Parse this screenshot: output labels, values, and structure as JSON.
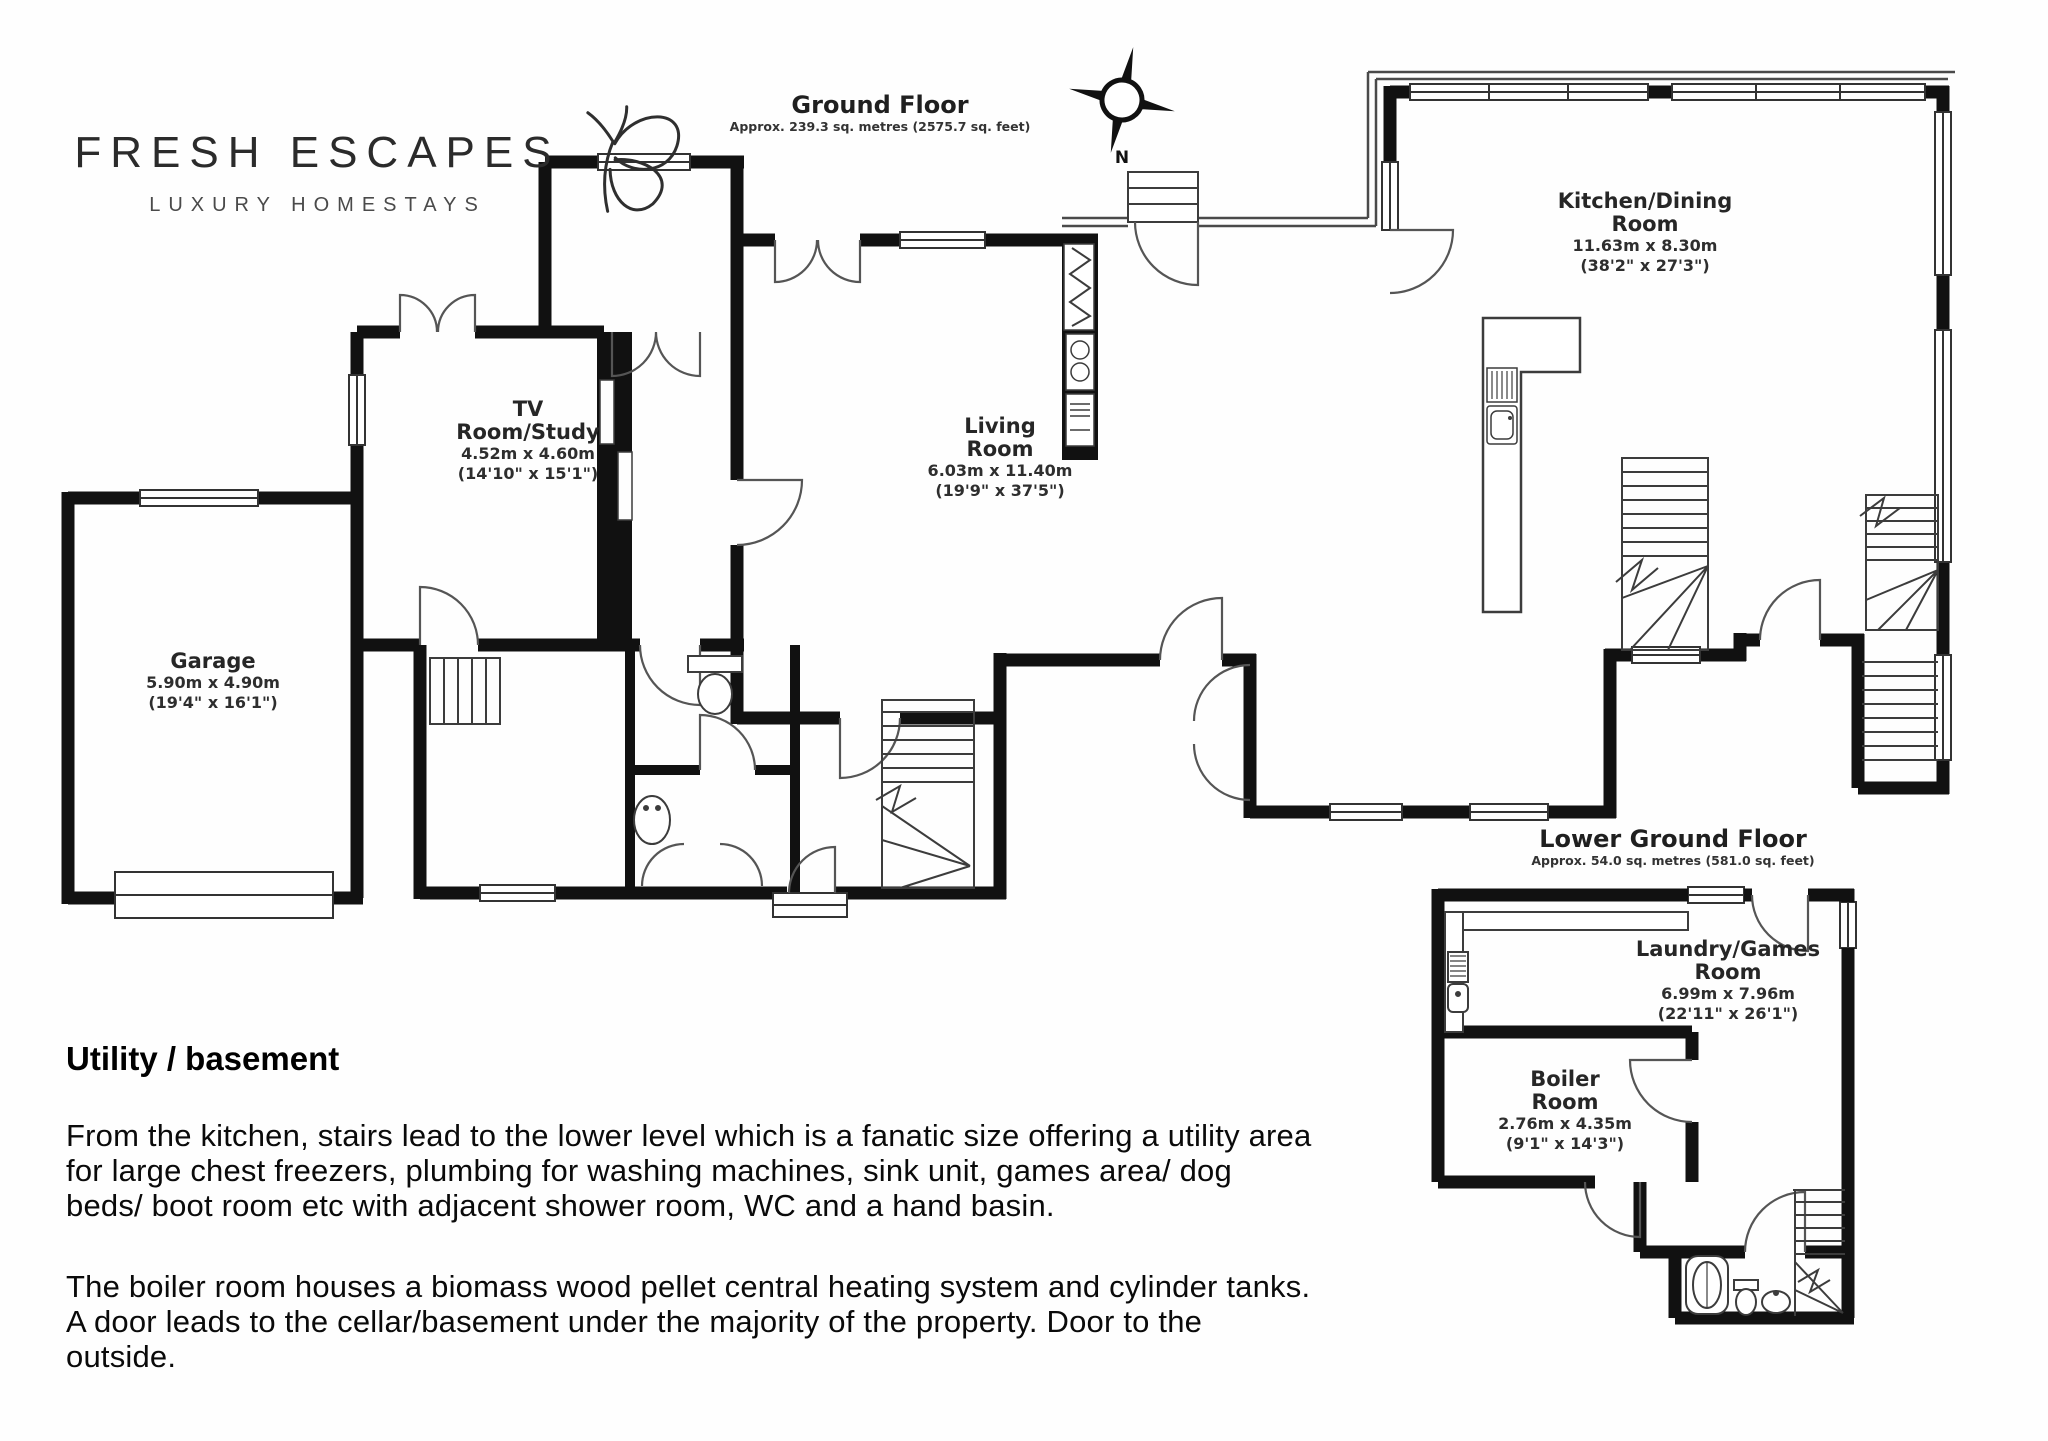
{
  "brand": {
    "name": "FRESH ESCAPES",
    "tagline": "LUXURY HOMESTAYS",
    "icon": "butterfly-icon"
  },
  "ground_floor": {
    "title": "Ground Floor",
    "area": "Approx. 239.3 sq. metres (2575.7 sq. feet)",
    "compass_label": "N",
    "rooms": {
      "kitchen": {
        "name_line1": "Kitchen/Dining",
        "name_line2": "Room",
        "metric": "11.63m x 8.30m",
        "imperial": "(38'2\" x 27'3\")"
      },
      "tv": {
        "name_line1": "TV",
        "name_line2": "Room/Study",
        "metric": "4.52m x 4.60m",
        "imperial": "(14'10\" x 15'1\")"
      },
      "living": {
        "name_line1": "Living",
        "name_line2": "Room",
        "metric": "6.03m x 11.40m",
        "imperial": "(19'9\" x 37'5\")"
      },
      "garage": {
        "name_line1": "Garage",
        "metric": "5.90m x 4.90m",
        "imperial": "(19'4\" x 16'1\")"
      }
    }
  },
  "lower_ground_floor": {
    "title": "Lower Ground Floor",
    "area": "Approx. 54.0 sq. metres (581.0 sq. feet)",
    "rooms": {
      "laundry": {
        "name_line1": "Laundry/Games",
        "name_line2": "Room",
        "metric": "6.99m x 7.96m",
        "imperial": "(22'11\" x 26'1\")"
      },
      "boiler": {
        "name_line1": "Boiler",
        "name_line2": "Room",
        "metric": "2.76m x 4.35m",
        "imperial": "(9'1\" x 14'3\")"
      }
    }
  },
  "description": {
    "heading": "Utility / basement",
    "paragraphs": [
      "From the kitchen, stairs lead to the lower level which is a fanatic size offering a utility area for large chest freezers, plumbing for washing machines, sink unit, games area/ dog beds/ boot room etc with adjacent shower room, WC and a hand basin.",
      "The boiler room houses a biomass wood pellet central heating system and cylinder tanks. A door leads to the cellar/basement under the majority of the property. Door to the outside."
    ]
  }
}
